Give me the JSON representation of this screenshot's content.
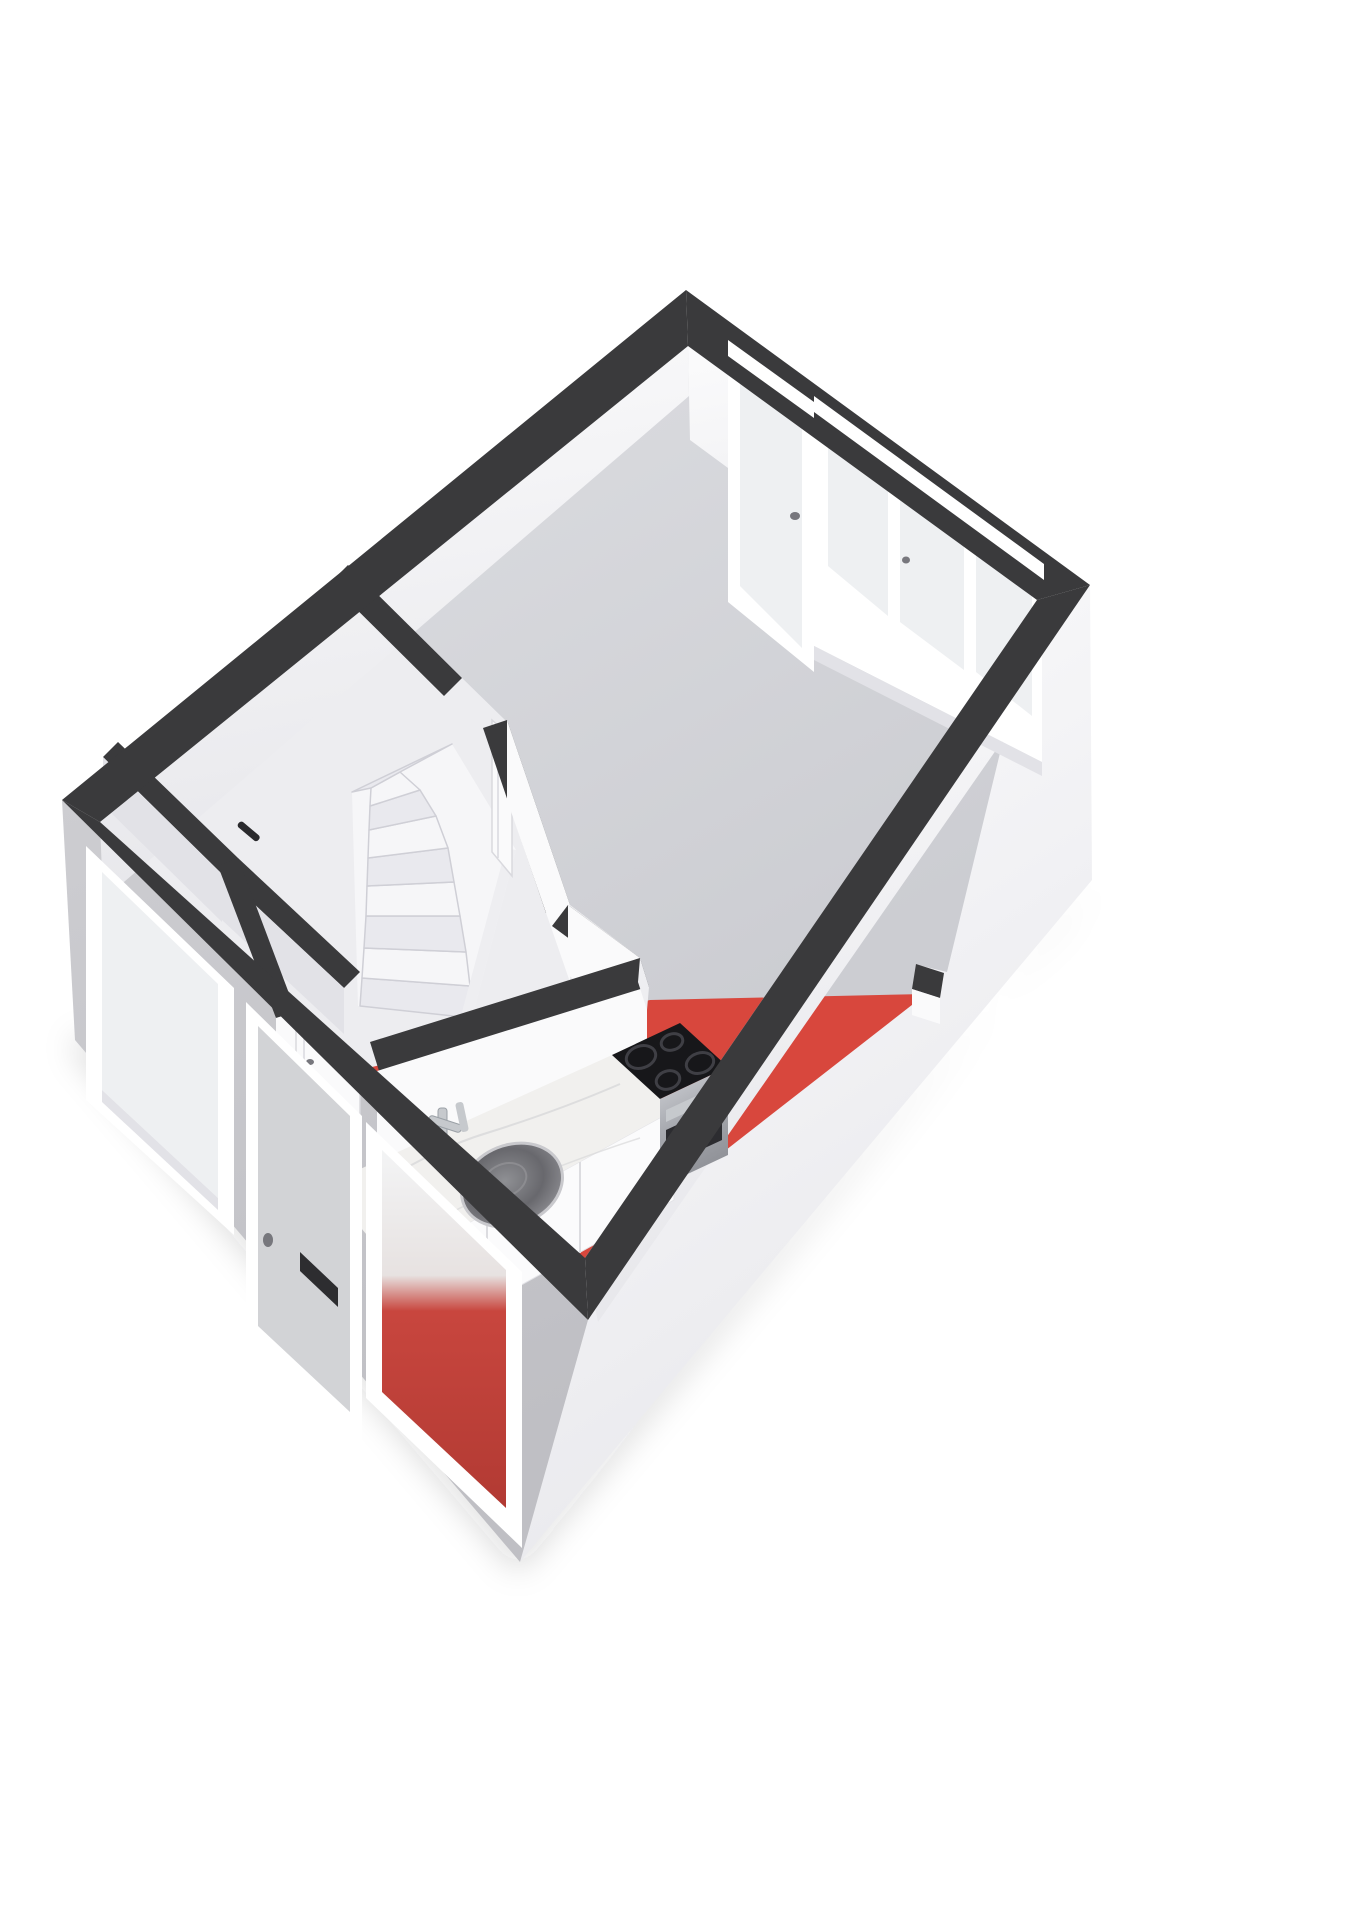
{
  "meta": {
    "title": "3D cutaway floor plan - ground floor",
    "view": "isometric-3d-floorplan",
    "background": "#ffffff"
  },
  "colors": {
    "wallTop": "#3a3a3c",
    "wallTopSoft": "#444447",
    "faceLight": "#fafafb",
    "faceMid": "#eeeef1",
    "faceShade": "#e2e2e7",
    "faceDark": "#d7d7dc",
    "floorLiving": "#d3d4d8",
    "floorHall": "#ededf0",
    "floorKitchen": "#d8473d",
    "exteriorFront": "#c7c7cb",
    "exteriorSide": "#f3f3f5",
    "frame": "#ffffff",
    "glass": "#eef0f2",
    "glassRed": "#c8463e",
    "doorPanel": "#d2d3d6",
    "letterbox": "#2d2d30",
    "handle": "#77777d",
    "marble": "#f1f0ee",
    "marbleVein": "#d8d8da",
    "cabinet": "#fbfbfc",
    "cabinetSeam": "#dcdce0",
    "cooktop": "#17171a",
    "burner": "#3f3f45",
    "oven": "#b8bac0",
    "ovenDark": "#2c2c30",
    "sinkOuter": "#a8a8ac",
    "sinkInner": "#5f5f64",
    "chrome": "#c6c9cd",
    "stepLight": "#f6f6f8",
    "stepShade": "#e9e9ee",
    "stepEdge": "#cfcfd6",
    "shadow": "rgba(40,40,45,0.16)"
  },
  "rooms": [
    {
      "id": "living-room",
      "floor": "gray"
    },
    {
      "id": "kitchen",
      "floor": "red"
    },
    {
      "id": "hallway",
      "floor": "white"
    },
    {
      "id": "toilet",
      "floor": "white"
    },
    {
      "id": "storage-closet",
      "floor": "white"
    }
  ],
  "fixtures": [
    "winder-staircase",
    "kitchen-counter",
    "round-sink",
    "faucet",
    "induction-cooktop",
    "oven",
    "front-door-with-letterbox",
    "hall-facade-window",
    "kitchen-facade-window",
    "rear-glazed-door",
    "rear-window-assembly",
    "toilet-door",
    "closet-door",
    "living-room-door",
    "wall-pier-stub"
  ]
}
